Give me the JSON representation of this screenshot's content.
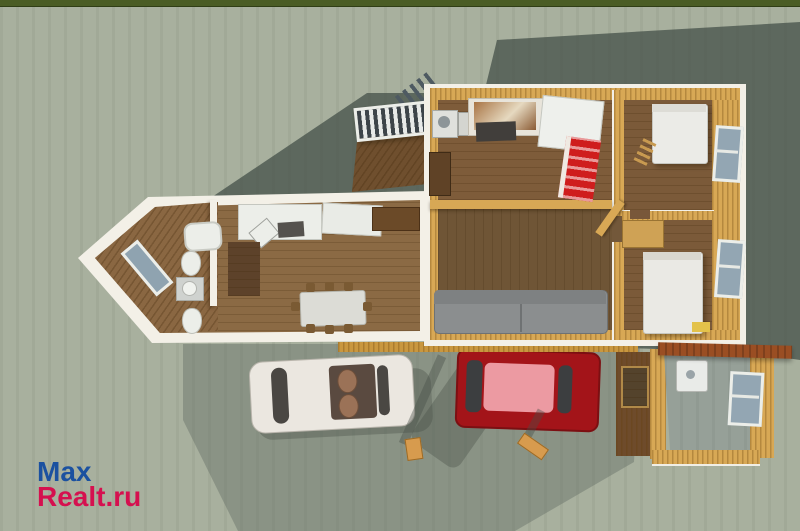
{
  "watermark": {
    "line1": "Max",
    "line2": "Realt.ru",
    "line1_color": "#1b51a0",
    "line2_color": "#d5104f"
  },
  "scene": {
    "description": "3D aerial render of a single-storey house with open roof showing furnished rooms, parked white and red cars, lawn and cast shadow",
    "colors": {
      "ground": "#a8b09e",
      "hedge_strip": "#4a5c24",
      "cast_shadow": "#5d685e",
      "driveway_shade": "#616b63",
      "wall_trim_white": "#f3f0e7",
      "wood_wall_gold": "#d8a855",
      "floor_wood": "#7e5e3c",
      "bay_floor_wood": "#8a6742",
      "sofa_gray": "#8b8e8f",
      "red_cabinet": "#cf1d1d",
      "beam_brown": "#9a4e23",
      "white_car": "#ebe7e0",
      "red_car_body": "#a31419",
      "red_car_roof": "#ec9aa2",
      "window_glass": "#93a6b3",
      "annex_floor_gray": "#96a098"
    },
    "rooms": [
      "bathroom",
      "kitchen-dining-room",
      "kitchen",
      "living-room",
      "bedroom-1",
      "bedroom-2",
      "utility-annex"
    ],
    "objects": [
      "bathtub",
      "toilet",
      "sink",
      "dining-table",
      "chairs",
      "kitchen-counters",
      "stove",
      "washing-machine",
      "red-shelf-unit",
      "sofa",
      "bed",
      "windows",
      "entry-canopy",
      "wooden-beam",
      "white-car",
      "red-car",
      "wooden-stakes"
    ]
  }
}
